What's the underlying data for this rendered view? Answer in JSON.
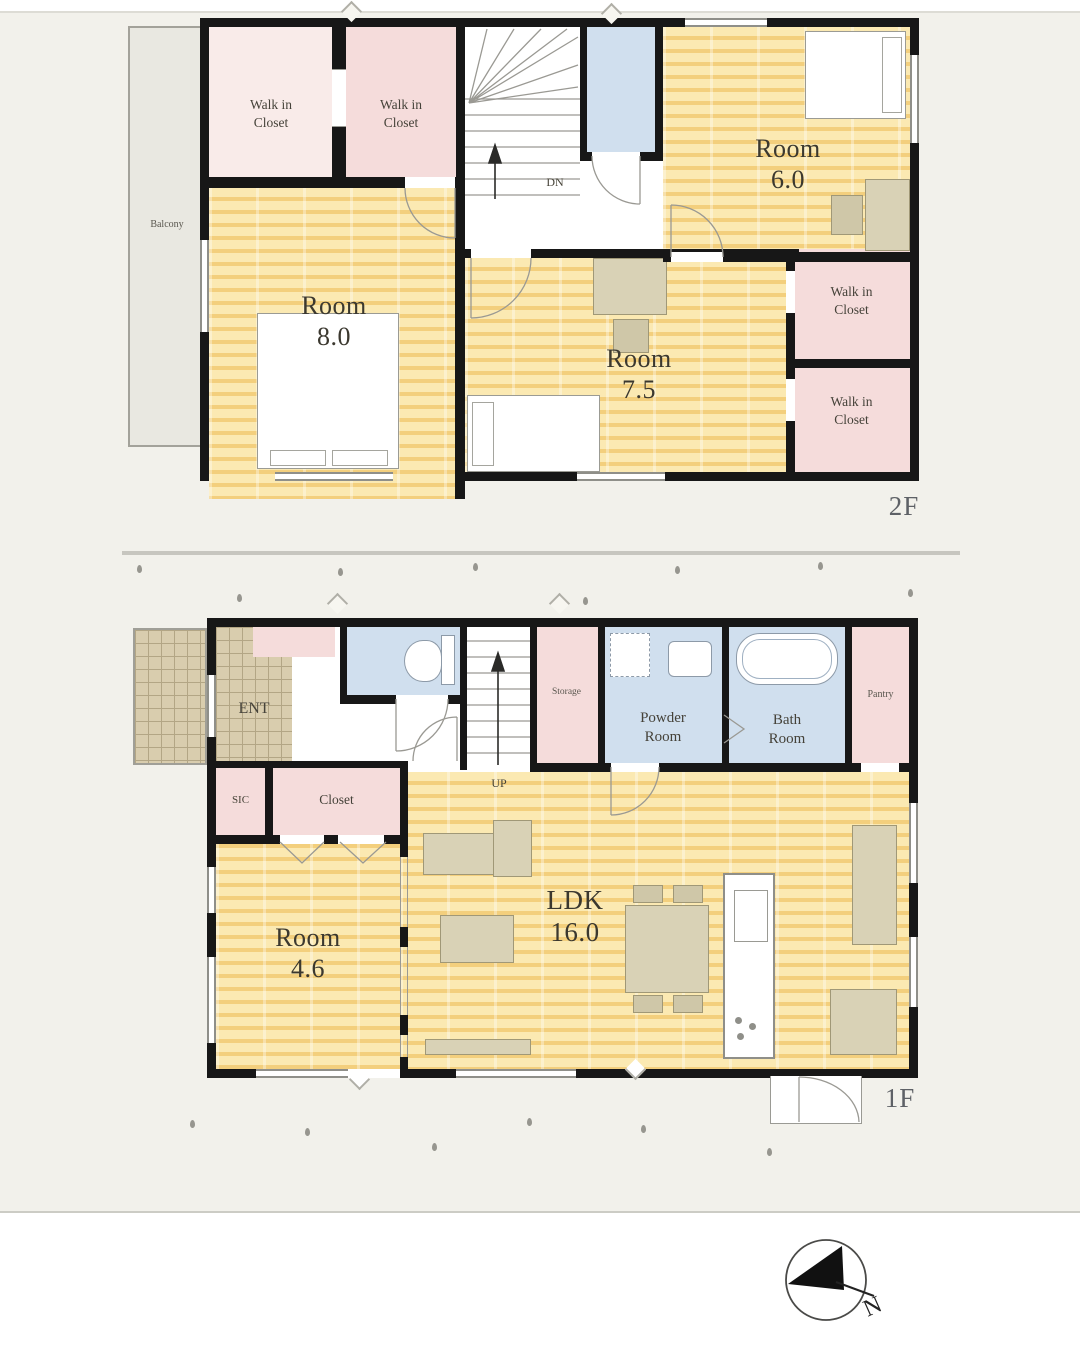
{
  "floors": {
    "f2": {
      "floor_label": "2F",
      "balcony": "Balcony",
      "wic": "Walk in\nCloset",
      "dn": "DN",
      "room6": "Room\n6.0",
      "room8": "Room\n8.0",
      "room75": "Room\n7.5"
    },
    "f1": {
      "floor_label": "1F",
      "ent": "ENT",
      "sic": "SIC",
      "closet": "Closet",
      "up": "UP",
      "storage": "Storage",
      "powder": "Powder\nRoom",
      "bath": "Bath\nRoom",
      "pantry": "Pantry",
      "room46": "Room\n4.6",
      "ldk": "LDK\n16.0"
    }
  },
  "compass": {
    "north": "N"
  },
  "palette": {
    "wall": "#171717",
    "wood_floor": "#fbe9b2",
    "closet_pink": "#f5dcdb",
    "sanitary_blue": "#d0dfee",
    "entrance_tile": "#d9cdae",
    "balcony_gray": "#e9e8e1",
    "furniture_beige": "#d9d2b6",
    "background_cream": "#f2f1eb"
  }
}
